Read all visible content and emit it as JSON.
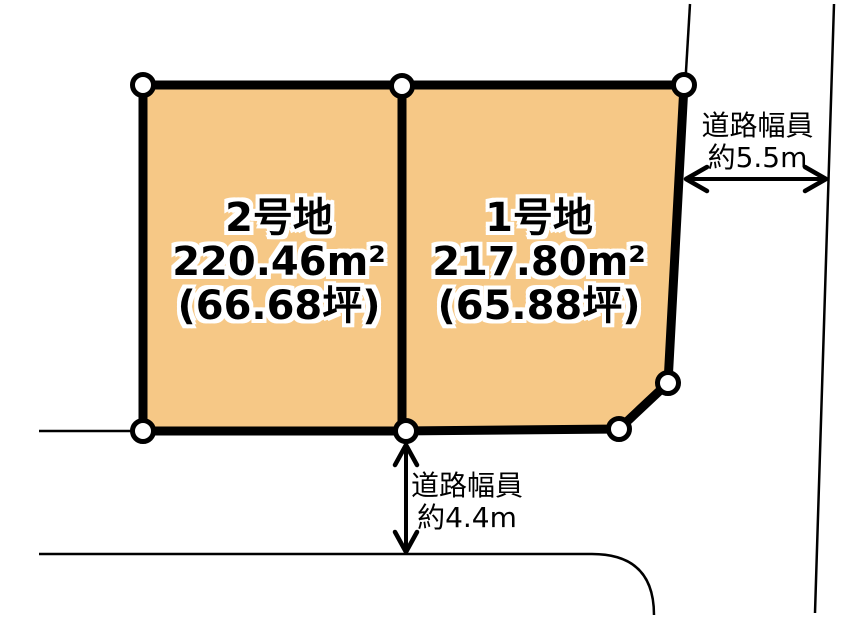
{
  "diagram": {
    "type": "land-parcel-plan",
    "plots": [
      {
        "name": "2号地",
        "area_m2": "220.46m²",
        "area_tsubo": "(66.68坪)"
      },
      {
        "name": "1号地",
        "area_m2": "217.80m²",
        "area_tsubo": "(65.88坪)"
      }
    ],
    "annotations": {
      "right_road": {
        "label": "道路幅員",
        "value": "約5.5m"
      },
      "bottom_road": {
        "label": "道路幅員",
        "value": "約4.4m"
      }
    },
    "colors": {
      "parcel_fill": "#F6C886",
      "line": "#000000",
      "marker_fill": "#FFFFFF",
      "background": "#FFFFFF"
    }
  }
}
